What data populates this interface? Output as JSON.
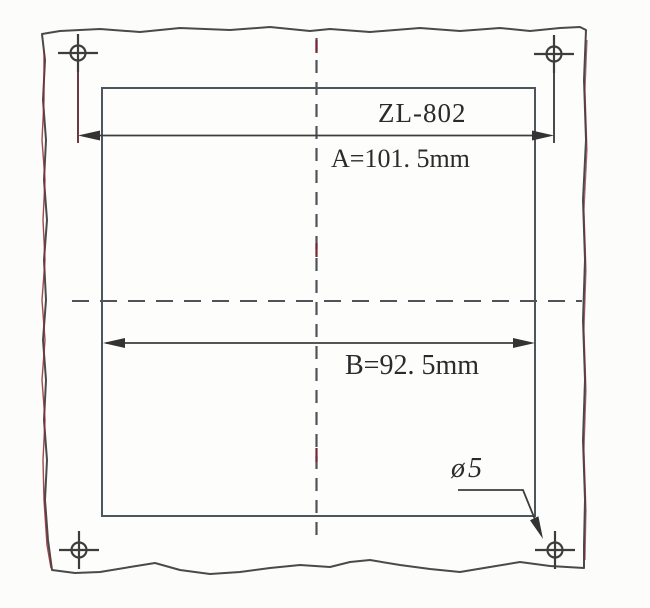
{
  "drawing": {
    "model_label": "ZL-802",
    "dim_a": {
      "label": "A=101. 5mm",
      "name": "A",
      "value_mm": 101.5
    },
    "dim_b": {
      "label": "B=92. 5mm",
      "name": "B",
      "value_mm": 92.5
    },
    "hole": {
      "label": "ø5",
      "diameter_mm": 5,
      "count": 4
    },
    "colors": {
      "line": "#3d3d3d",
      "cutout_line": "#4b565e",
      "centerline": "#53525a",
      "scan_red": "#7b2733",
      "paper": "#fcfcfa"
    }
  }
}
